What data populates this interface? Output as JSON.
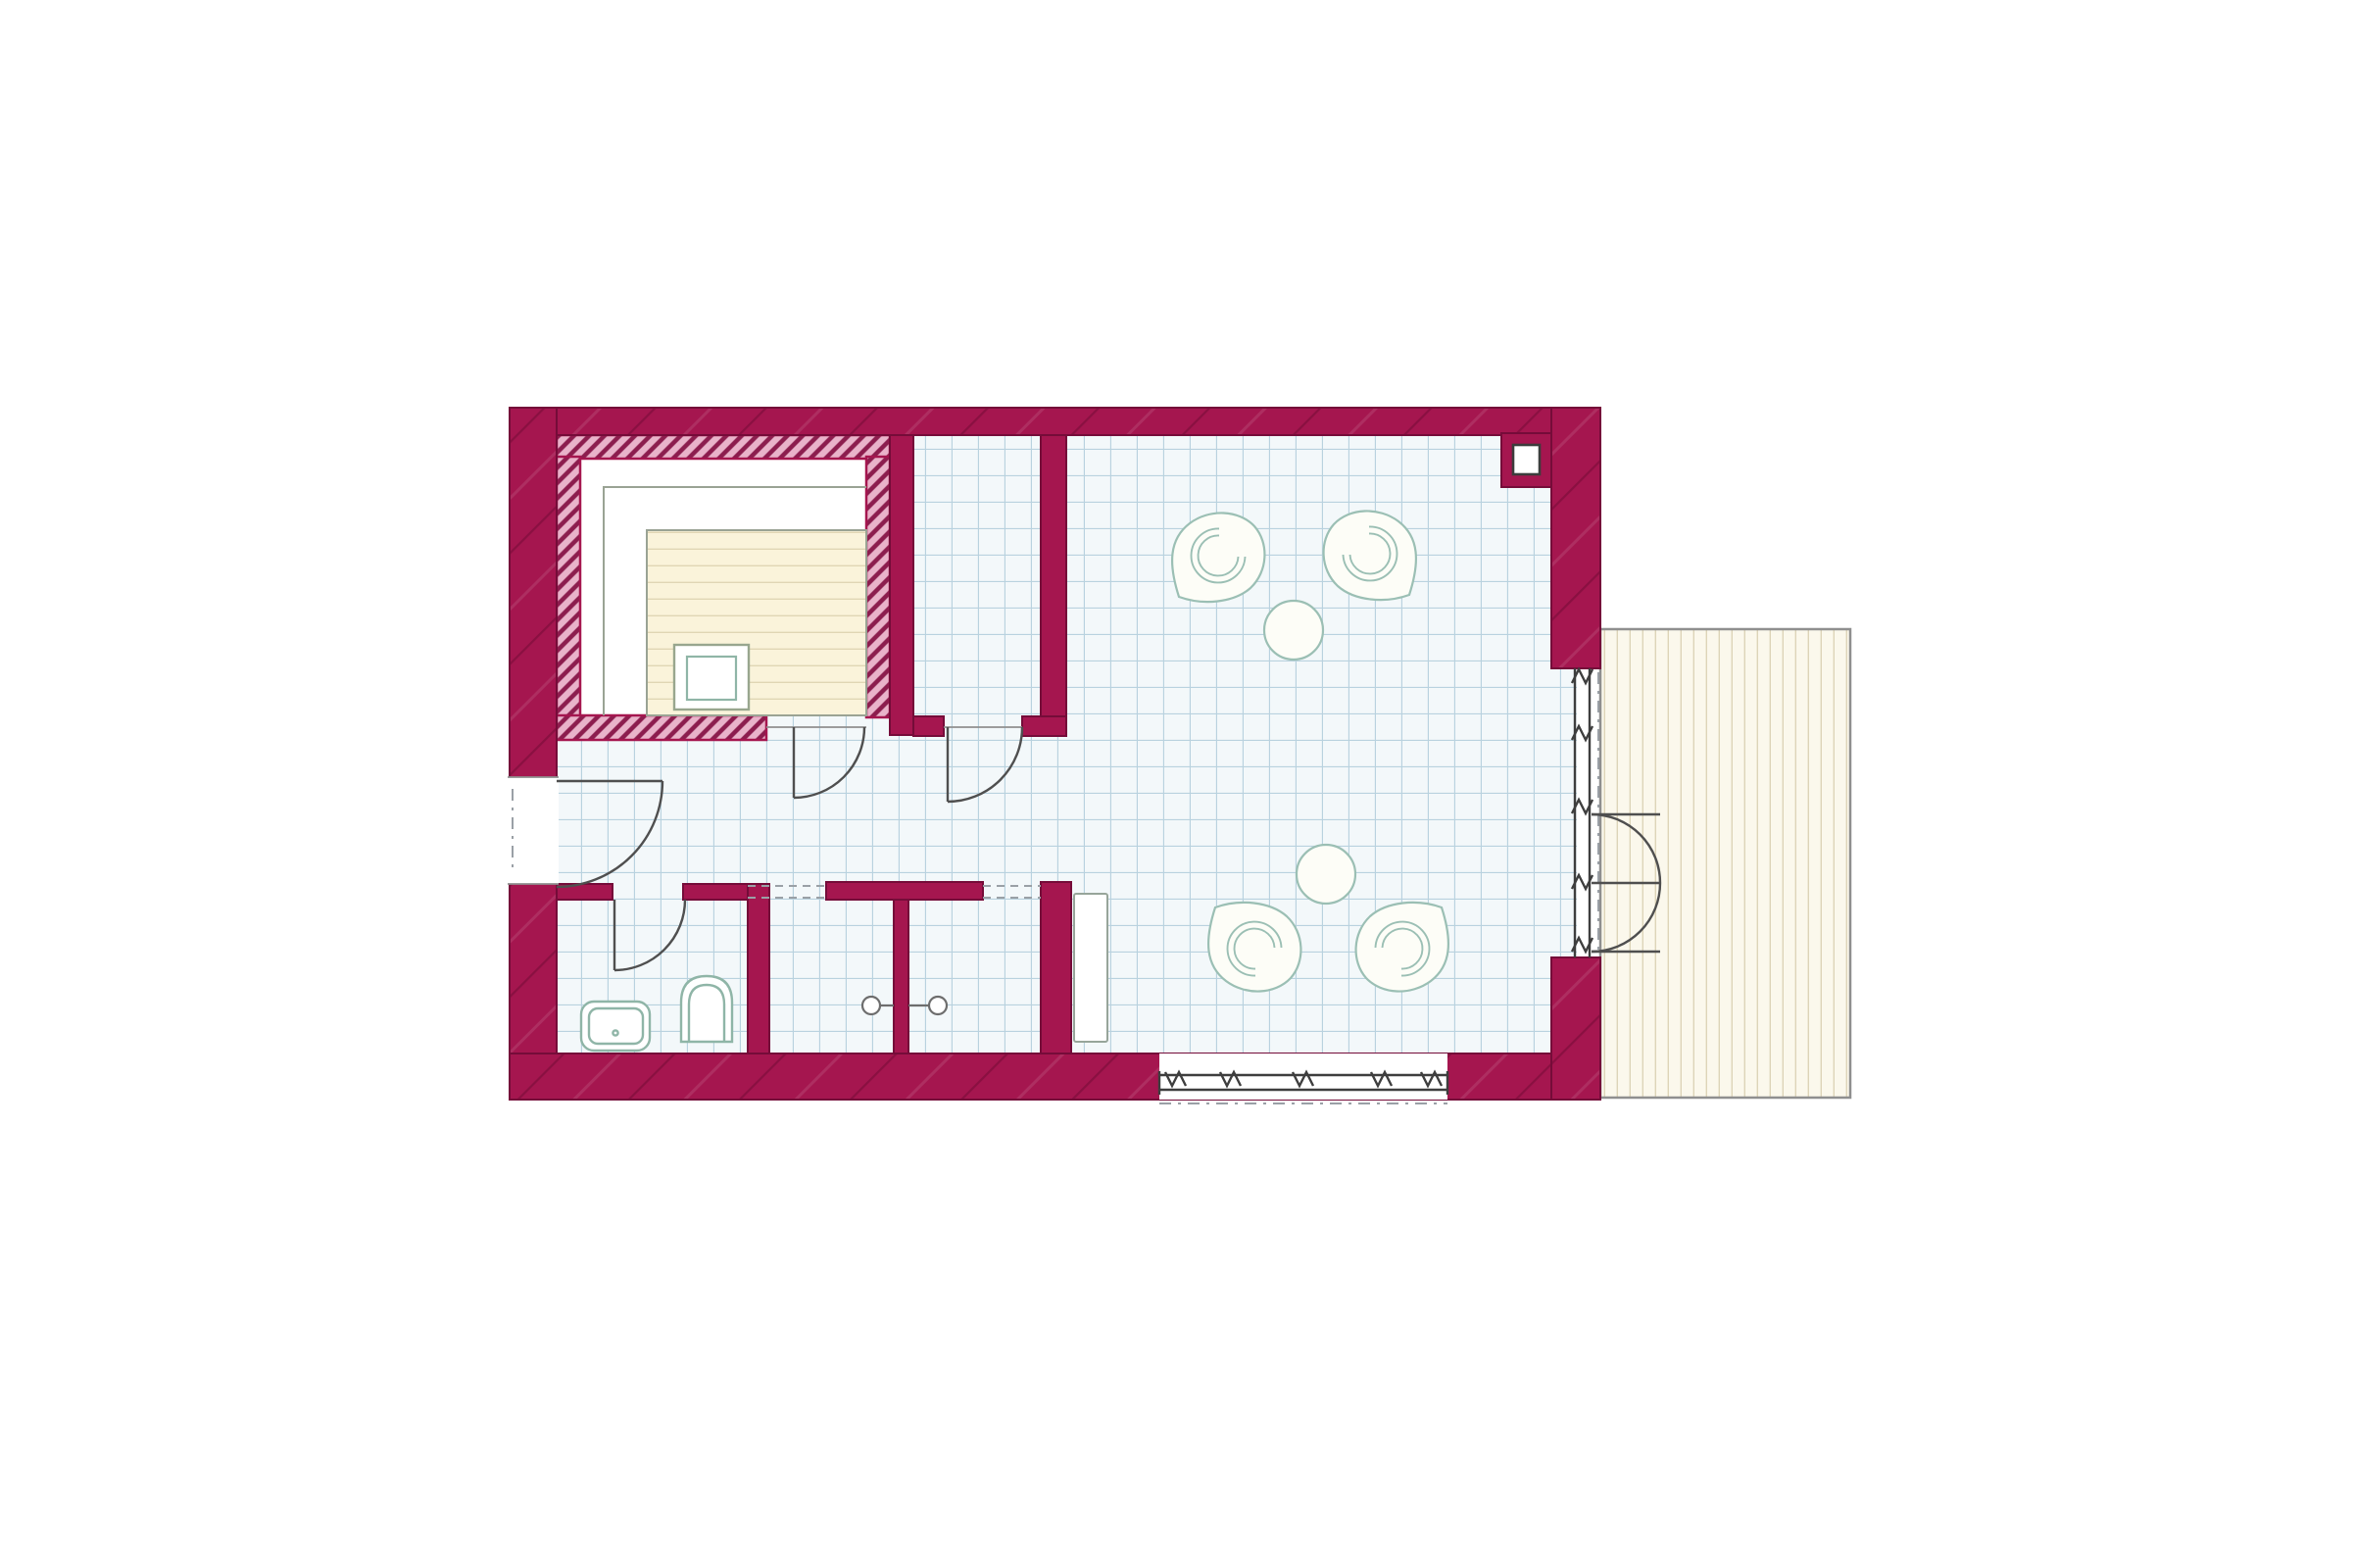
{
  "palette": {
    "bg": "#ffffff",
    "wall": "#a5164f",
    "wall_dark": "#750c39",
    "hatch_fill": "#e9b3ca",
    "hatch_line": "#8c1d4e",
    "tile_bg": "#f3f8fa",
    "tile_line": "#b9d2df",
    "bench_cream": "#faf3da",
    "bench_line": "#e0d6b4",
    "bench_outline": "#9aa394",
    "fixture": "#8fb5a7",
    "furniture": "#9bbfb4",
    "terrace_bg": "#fbf8ec",
    "terrace_line": "#ddd4b8",
    "terrace_border": "#8f8f8f",
    "door_arc": "#4f4f4f",
    "frame": "#3e3e3e",
    "dash": "#9aa0a6",
    "floor_white": "#ffffff"
  },
  "plan": {
    "type": "floor-plan",
    "rooms": [
      {
        "id": "sauna",
        "floor": "wood-bench-tiers"
      },
      {
        "id": "vestibule",
        "floor": "tile"
      },
      {
        "id": "hallway",
        "floor": "tile"
      },
      {
        "id": "bathroom",
        "floor": "tile"
      },
      {
        "id": "shower-1",
        "floor": "tile"
      },
      {
        "id": "shower-2",
        "floor": "tile"
      },
      {
        "id": "lounge",
        "floor": "tile"
      },
      {
        "id": "terrace",
        "floor": "wood-deck"
      }
    ],
    "fixtures": [
      "sauna-heater",
      "washbasin",
      "toilet",
      "shower-head",
      "shower-head",
      "chimney"
    ],
    "furniture": {
      "round_tables": 2,
      "tub_chairs": 4,
      "wall_panel": 1
    },
    "doors": [
      "entrance-door",
      "sauna-door",
      "vestibule-door",
      "bathroom-door",
      "french-double-door"
    ],
    "windows": [
      "south-window-band",
      "east-glazed-wall"
    ]
  }
}
